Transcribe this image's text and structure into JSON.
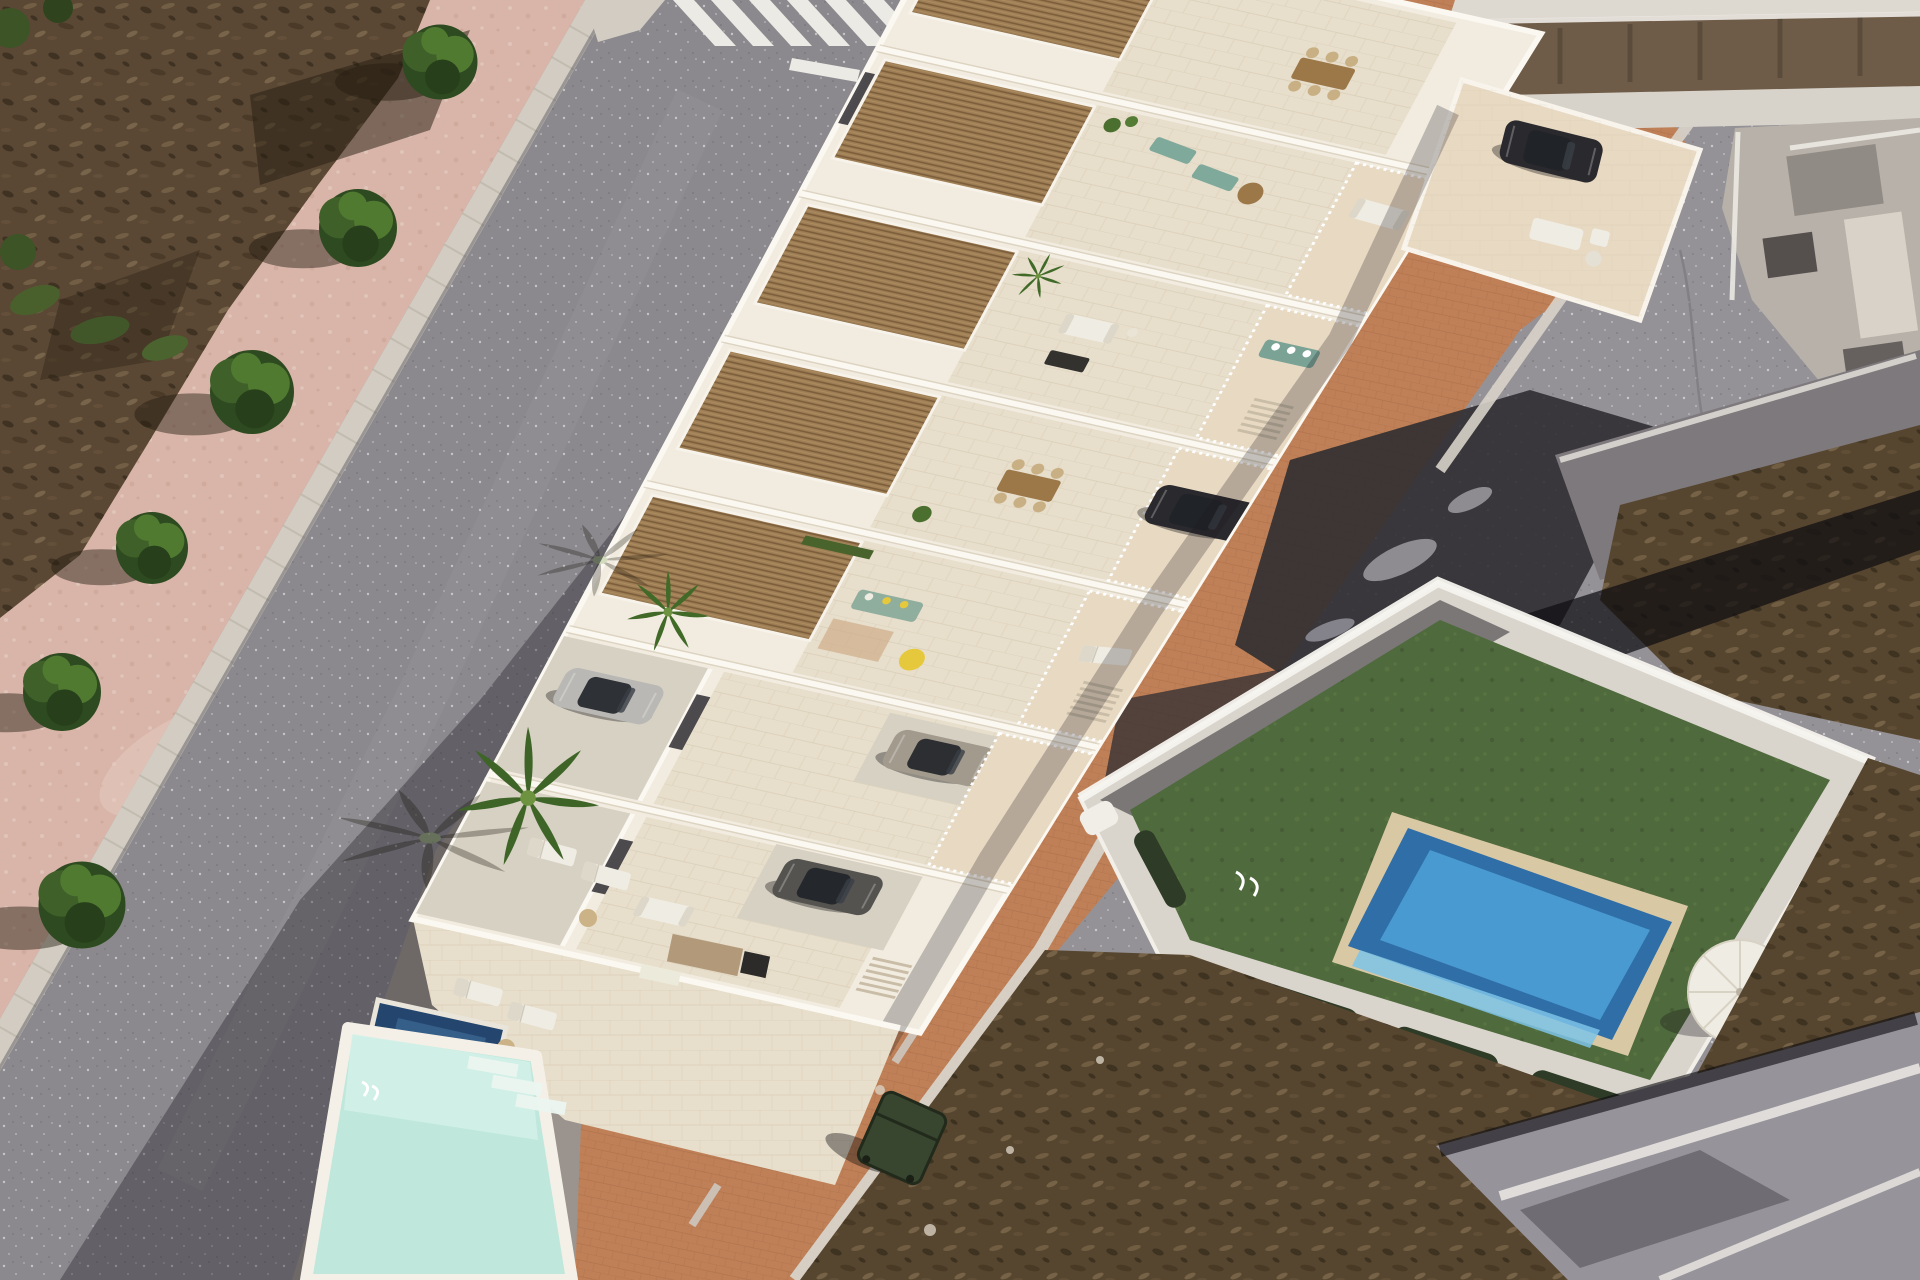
{
  "meta": {
    "title": "Aerial 3D architectural render of a new white townhouse development between two streets",
    "type": "architectural-aerial-render",
    "visible_text": []
  },
  "palette": {
    "base": "#9b938d",
    "dirtPink": "#d8b5a8",
    "dirtPinkLight": "#e8cfc4",
    "scrub": "#5a4834",
    "scrubB": "#57462f",
    "scrubDark": "#2a2014",
    "scrubLight": "#9b8767",
    "curb": "#d2ccc2",
    "roadMain": "#8b898d",
    "roadRight": "#949296",
    "asphaltDark": "#2f2d31",
    "crosswalk": "#eceae4",
    "shadow": "#17151c",
    "terracotta": "#c08057",
    "terracottaLine": "#a96f4a",
    "buildingWall": "#f2ece0",
    "wallShade": "#bdae95",
    "tileFloor": "#e7decb",
    "tileLine": "#d6c9b2",
    "pergolaWood": "#9f7f55",
    "pergolaLine": "#7a5c3a",
    "driveway": "#d7d1c3",
    "courtyardFloor": "#e8d9c2",
    "poolDeck": "#f4f0e7",
    "poolMint": "#bfe7dc",
    "poolMintLight": "#d6f1e9",
    "poolNavy": "#24466e",
    "poolBlue": "#2f6ea6",
    "poolBlueLight": "#4d9fd6",
    "poolBlueLighter": "#7cc3e8",
    "poolBorder": "#d9c8a4",
    "lawn": "#4f6a3c",
    "lawnLight": "#5d7a45",
    "hedge": "#2e3b26",
    "treeDark": "#2e4a20",
    "treeMid": "#3f6129",
    "treeLight": "#517a31",
    "palmGreen": "#416a28",
    "carSilver": "#b9b8b4",
    "carTan": "#a29a8d",
    "carDark": "#2a292d",
    "furnWhite": "#efece3",
    "furnTeal": "#7fa99b",
    "furnYellow": "#e6c83d",
    "furnWood": "#9c7748",
    "oldWallBrown": "#6e5c49",
    "oldBuildGrey": "#b7b1a9",
    "oldBuildLight": "#d8d2c8",
    "neighborRoof": "#97939b",
    "villaWall": "#d9d5cd",
    "binGreen": "#39462f",
    "white": "#ffffff"
  },
  "scene": {
    "areas": [
      {
        "name": "scrubland-top-left",
        "desc": "dry brown scrub field"
      },
      {
        "name": "pink-dirt-sidewalk",
        "desc": "rose-toned verge with street trees"
      },
      {
        "name": "main-road",
        "desc": "dark asphalt street running diagonally with zebra crosswalk at top"
      },
      {
        "name": "townhouse-complex",
        "desc": "white render townhouses with roof terraces, wooden pergolas, driveways and cars"
      },
      {
        "name": "communal-pool",
        "desc": "mint turquoise pool at the narrow tip of the plot"
      },
      {
        "name": "plunge-pool",
        "desc": "small navy private pool"
      },
      {
        "name": "right-road",
        "desc": "second grey street with dashed centre line and dark asphalt patch"
      },
      {
        "name": "old-town-buildings",
        "desc": "existing grey buildings top right"
      },
      {
        "name": "villa-plot",
        "desc": "walled villa with artificial lawn, blue pool, parasol and loungers"
      },
      {
        "name": "scrubland-bottom-right",
        "desc": "dry brown waste ground"
      },
      {
        "name": "neighbor-roof",
        "desc": "grey flat roof in bottom-right corner"
      }
    ],
    "counts": {
      "street_trees": 6,
      "bushes": 4,
      "cars": 5,
      "banana_palms": 3,
      "sun_loungers": 8,
      "parasols": 1,
      "waste_bins": 1,
      "crosswalk_stripes": 7,
      "pools": {
        "communal_mint": 1,
        "private_plunge": 1,
        "villa_blue": 1
      }
    }
  }
}
